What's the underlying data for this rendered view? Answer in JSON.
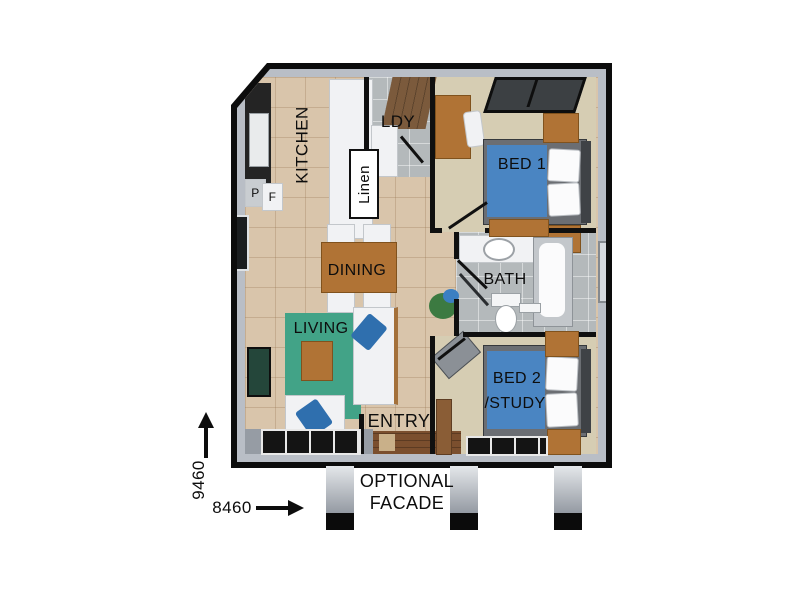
{
  "labels": {
    "kitchen": "KITCHEN",
    "laundry": "LDY",
    "linen": "Linen",
    "pantry": "P",
    "fridge": "F",
    "bed1": "BED 1",
    "dining": "DINING",
    "bath": "BATH",
    "living": "LIVING",
    "bed2_line1": "BED 2",
    "bed2_line2": "/STUDY",
    "entry": "ENTRY",
    "facade_line1": "OPTIONAL",
    "facade_line2": "FACADE"
  },
  "dimensions": {
    "vertical": "9460",
    "horizontal": "8460"
  },
  "colors": {
    "wall": "#0c0c0c",
    "floor_tile_beige": "#d9c5ab",
    "wet_area_grey": "#b4b9bb",
    "carpet": "#d6cdb3",
    "bed_blue": "#4a85c2",
    "rug_green": "#42a387",
    "wood_brown": "#b07335",
    "porch_grey": "#9aa0a8"
  }
}
